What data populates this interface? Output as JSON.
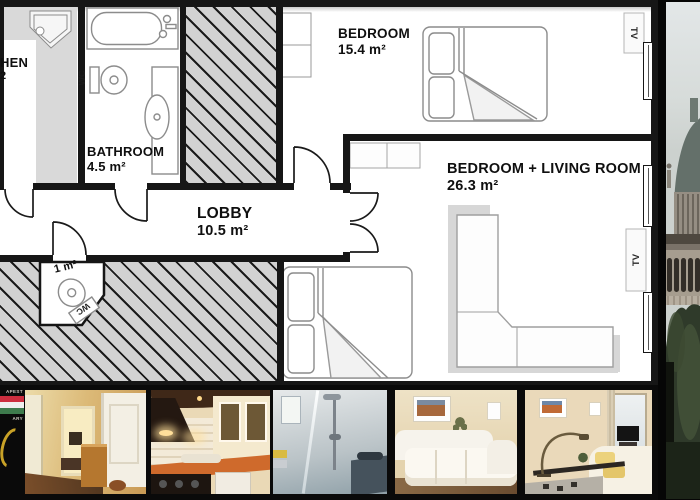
{
  "floor_plan": {
    "rooms": {
      "kitchen": {
        "label_fragment": "HEN",
        "area_fragment": "2"
      },
      "bathroom": {
        "label": "BATHROOM",
        "area": "4.5 m²"
      },
      "lobby": {
        "label": "LOBBY",
        "area": "10.5 m²"
      },
      "bedroom": {
        "label": "BEDROOM",
        "area": "15.4 m²"
      },
      "bedroom_living_room": {
        "label": "BEDROOM + LIVING ROOM",
        "area": "26.3 m²"
      },
      "wc": {
        "area": "1 m²",
        "fixture_label": "WC"
      }
    },
    "fixtures": {
      "bathroom_wc_label": "WC",
      "bedroom_tv_label": "TV",
      "living_room_tv_label": "TV"
    },
    "colors": {
      "wall": "#161616",
      "hatch_bg": "#d2d2d2",
      "hatch_line": "#1a1a1a",
      "counter": "#d9d9d9",
      "floor": "#ffffff"
    }
  },
  "branding": {
    "top_text_fragment": "APEST",
    "bottom_text_fragment": "ARY",
    "flag_colors": [
      "#cc2e3f",
      "#efefef",
      "#3e7b4d"
    ],
    "emblem_color": "#c9a227"
  },
  "photo_strip": {
    "background": "#0a0a0a",
    "photos": [
      {
        "name": "hallway-photo"
      },
      {
        "name": "kitchen-photo"
      },
      {
        "name": "shower-photo"
      },
      {
        "name": "living-room-photo"
      },
      {
        "name": "bedroom-photo"
      }
    ]
  },
  "side_photo": {
    "name": "basilica-street-photo"
  }
}
